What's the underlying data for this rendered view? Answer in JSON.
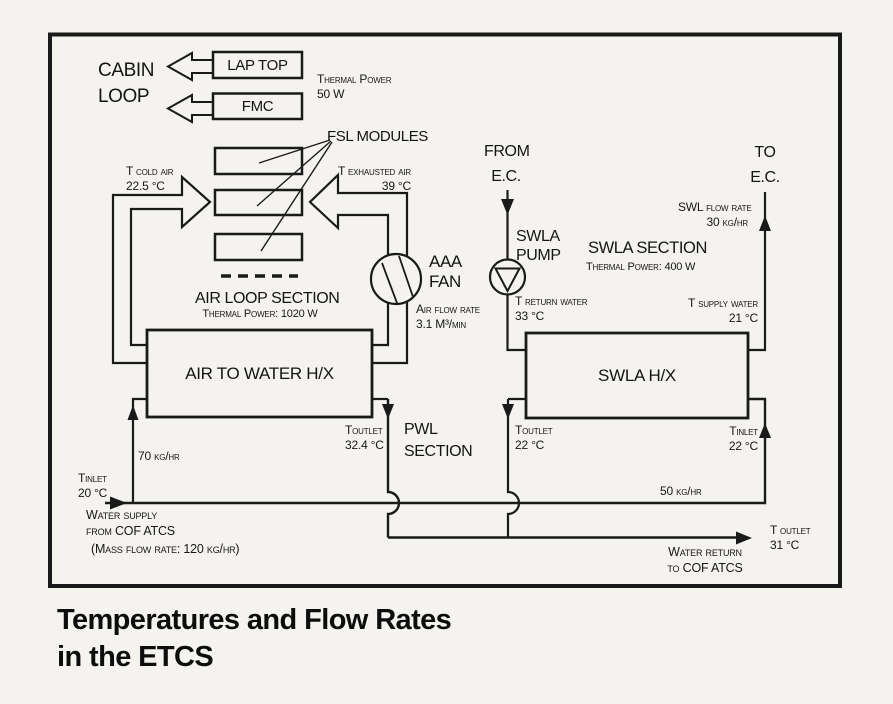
{
  "colors": {
    "ink": "#1a1a1a",
    "paper": "#f5f3ef"
  },
  "caption": {
    "line1": "Temperatures and Flow Rates",
    "line2": "in the ETCS"
  },
  "boxes": {
    "lap_top": "LAP TOP",
    "fmc": "FMC",
    "air_hx": "AIR TO WATER H/X",
    "swla_hx": "SWLA H/X"
  },
  "labels": {
    "cabin1": "CABIN",
    "cabin2": "LOOP",
    "thermal_cabin1": "Thermal Power",
    "thermal_cabin2": "50 W",
    "fsl": "FSL MODULES",
    "tcold1": "T cold air",
    "tcold2": "22.5 °C",
    "texh1": "T exhausted air",
    "texh2": "39 °C",
    "air_loop": "AIR LOOP SECTION",
    "air_loop_power": "Thermal Power: 1020 W",
    "fan1": "AAA",
    "fan2": "FAN",
    "airflow1": "Air flow rate",
    "airflow2": "3.1 M³/min",
    "from1": "FROM",
    "from2": "E.C.",
    "to1": "TO",
    "to2": "E.C.",
    "pump1": "SWLA",
    "pump2": "PUMP",
    "swla_sec": "SWLA SECTION",
    "swla_power": "Thermal Power: 400 W",
    "swl_flow1": "SWL flow rate",
    "swl_flow2": "30 kg/hr",
    "tret1": "T return water",
    "tret2": "33 °C",
    "tsup1": "T supply water",
    "tsup2": "21 °C",
    "tout_air1": "Toutlet",
    "tout_air2": "32.4 °C",
    "pwl1": "PWL",
    "pwl2": "SECTION",
    "tout_swla1": "Toutlet",
    "tout_swla2": "22 °C",
    "tin_swla1": "Tinlet",
    "tin_swla2": "22 °C",
    "flow70": "70 kg/hr",
    "tin_sup1": "Tinlet",
    "tin_sup2": "20 °C",
    "wsup1": "Water supply",
    "wsup2": "from COF ATCS",
    "mass": "(Mass flow rate: 120 kg/hr)",
    "flow50": "50 kg/hr",
    "tout1": "T outlet",
    "tout2": "31 °C",
    "wret1": "Water return",
    "wret2": "to COF ATCS"
  }
}
